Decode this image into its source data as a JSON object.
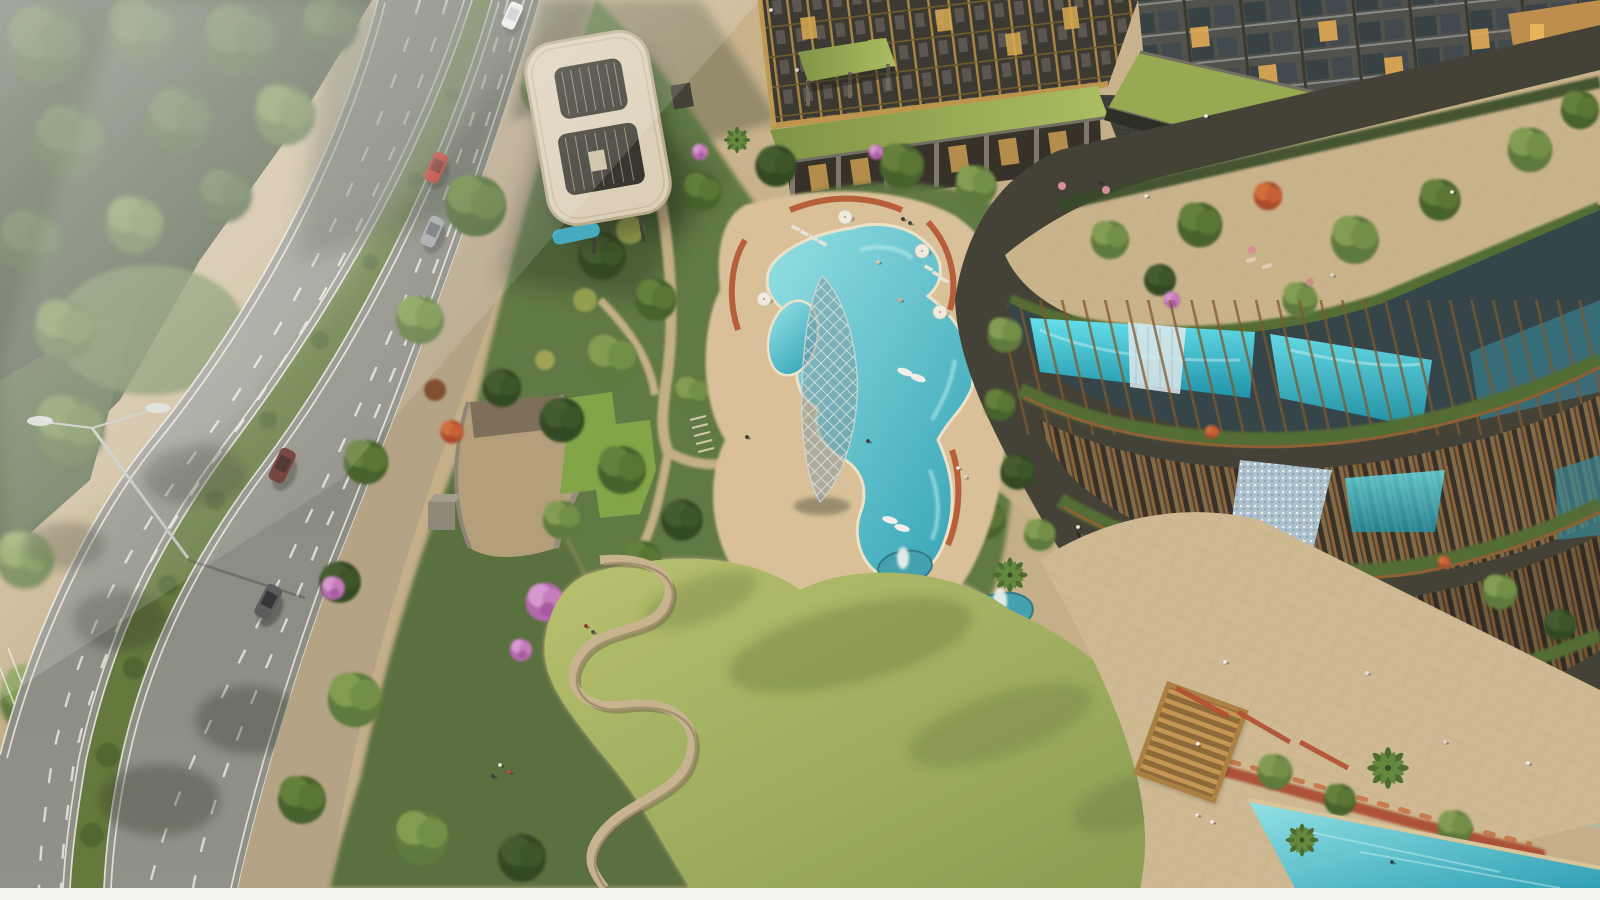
{
  "scene": {
    "type": "aerial-architectural-rendering",
    "description": "Aerial rendering of a residential resort development: a diagonal multi-lane road with median and cars on the left, landscaped gardens with winding paths, a figure-8 shaped cream entrance canopy, a freeform turquoise swimming pool with umbrellas and loungers, a white diamond-lattice sculpture tower, fountain ponds, a large sunlit lawn with serpentine seating walls, and a curved terraced building with planted balconies and glass aquarium water-walls; residential towers with lit windows and a green-roof podium at top; lap pool, red flower hedge and timber pergola at bottom right.",
    "road": {
      "lanes_per_carriageway": 3,
      "median": "planted shrub strip",
      "markings": "white dashed lane lines, double solid edge lines",
      "street_lamp_count": 1
    },
    "vehicles": [
      {
        "type": "van",
        "color": "white"
      },
      {
        "type": "car",
        "color": "red"
      },
      {
        "type": "car",
        "color": "silver"
      },
      {
        "type": "suv",
        "color": "maroon"
      },
      {
        "type": "car",
        "color": "dark-gray"
      }
    ],
    "water_features": {
      "central_pool": "freeform turquoise lagoon pool with swim-up lobes",
      "kids_pool": "small oval pool",
      "fountain_ponds": 3,
      "aquarium_walls": 2,
      "waterfall_wall": "mosaic glass waterfall",
      "lap_pool": "rectangular teal pool at bottom right",
      "canopy_pool": "small reflecting pool under canopy"
    },
    "structures": {
      "canopy": "figure-8 cream drop-off canopy on slim columns",
      "sculpture": "white diamond-lattice spindle tower",
      "pergola": "golden timber slatted pergola",
      "colonnade": "green-roof colonnade with lit storefronts",
      "portico": "small green-roof entrance portico",
      "ramp": "sunken curved vehicle ramp with grass verge"
    },
    "planting": {
      "flowering_pink_trees": 7,
      "flowering_red_trees": 3,
      "palms": 5,
      "umbrellas": 4
    }
  },
  "palette": {
    "ground": "#c2ad87",
    "plaza": "#c7b28c",
    "sidewalk": "#b3a184",
    "promenade": "#cdb891",
    "deck": "#d8bf97",
    "asphalt": "#85867f",
    "asphalt_dark": "#565a50",
    "road_line": "#e9e9e3",
    "median_green": "#5c7437",
    "park_shadow": "#2a3a22",
    "garden_base": "#55713a",
    "lawn_light": "#b5c06b",
    "lawn_dark": "#84984d",
    "pool_light": "#8fe2e8",
    "pool_deep": "#279fb6",
    "aqua_light": "#5fe0ee",
    "aqua_deep": "#1590a8",
    "waterfall_gray": "#a9bfd0",
    "canopy": "#dbcfb8",
    "canopy_edge": "#b7a98c",
    "charcoal": "#33362f",
    "bronze": "#7c5126",
    "gold_mullion": "#bb9248",
    "lit_window": "#e7b157",
    "green_roof": "#8ba349",
    "terracotta": "#b14e2a",
    "pergola_wood": "#c3944f",
    "flower_pink": "#c678bc",
    "flower_red": "#c65a2e",
    "lattice_white": "#e8eef0",
    "border_strip": "#f4f3f0"
  }
}
